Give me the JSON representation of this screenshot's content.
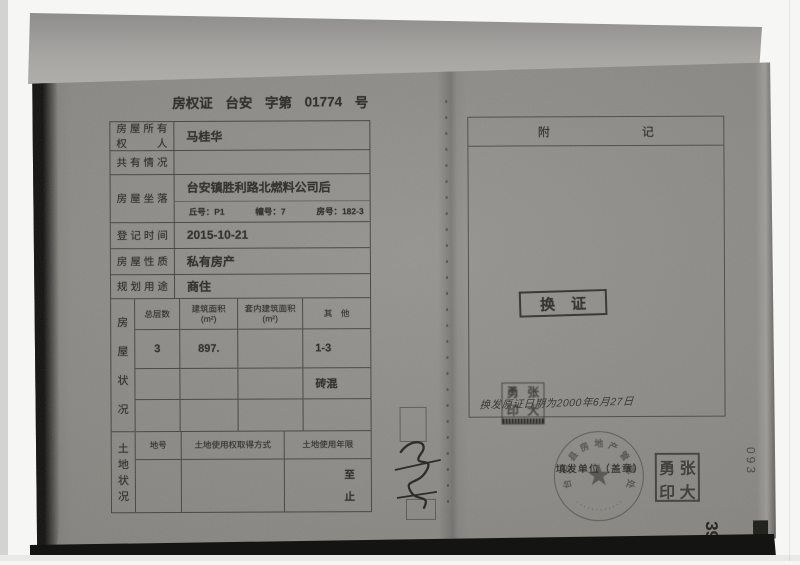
{
  "colors": {
    "paper_gray": "#8f8d88",
    "ink": "#2b2a27",
    "band_gray": "#a7a5a1"
  },
  "certificate": {
    "title": {
      "name": "房权证",
      "region": "台安",
      "zi_di": "字第",
      "number": "01774",
      "suffix": "号"
    },
    "fields": [
      {
        "label": "房屋所有权人",
        "value": "马桂华"
      },
      {
        "label": "共有情况",
        "value": ""
      },
      {
        "label": "房屋坐落",
        "value": "台安镇胜利路北燃料公司后"
      },
      {
        "label": "登记时间",
        "value": "2015-10-21"
      },
      {
        "label": "房屋性质",
        "value": "私有房产"
      },
      {
        "label": "规划用途",
        "value": "商住"
      }
    ],
    "location_sub": {
      "qiu": "丘号：P1",
      "zhuang": "幢号：7",
      "fang": "房号：182-3"
    },
    "house_status": {
      "side_chars": [
        "房",
        "屋",
        "状",
        "况"
      ],
      "headers": [
        {
          "l1": "总层数",
          "l2": ""
        },
        {
          "l1": "建筑面积",
          "l2": "(m²)"
        },
        {
          "l1": "套内建筑面积",
          "l2": "(m²)"
        },
        {
          "l1": "其　他",
          "l2": ""
        }
      ],
      "rows": [
        [
          "3",
          "897.",
          "",
          "1-3"
        ],
        [
          "",
          "",
          "",
          "砖混"
        ],
        [
          "",
          "",
          "",
          ""
        ]
      ]
    },
    "land_status": {
      "side_chars": [
        "土",
        "地",
        "状",
        "况"
      ],
      "headers": [
        "地号",
        "土地使用权取得方式",
        "土地使用年限"
      ],
      "row": {
        "di_hao": "",
        "fang_shi": "",
        "zhi_top": "至",
        "zhi_bottom": "止"
      }
    }
  },
  "right_page": {
    "fuji": {
      "left": "附",
      "right": "记"
    },
    "huanzheng": {
      "left": "换",
      "right": "证"
    },
    "handwriting": "换发原证日期为2000年6月27日",
    "issuer_label": "填发单位（盖章）",
    "round_stamp": {
      "arc_text": "台安县房地产管理处",
      "star": "★",
      "bottom_marks": "············"
    },
    "name_seal": {
      "chars": [
        "勇",
        "张",
        "印",
        "大"
      ]
    },
    "small_seal": {
      "chars": [
        "勇",
        "张",
        "印",
        "大"
      ]
    },
    "side_number": "093",
    "page_number": "39"
  }
}
